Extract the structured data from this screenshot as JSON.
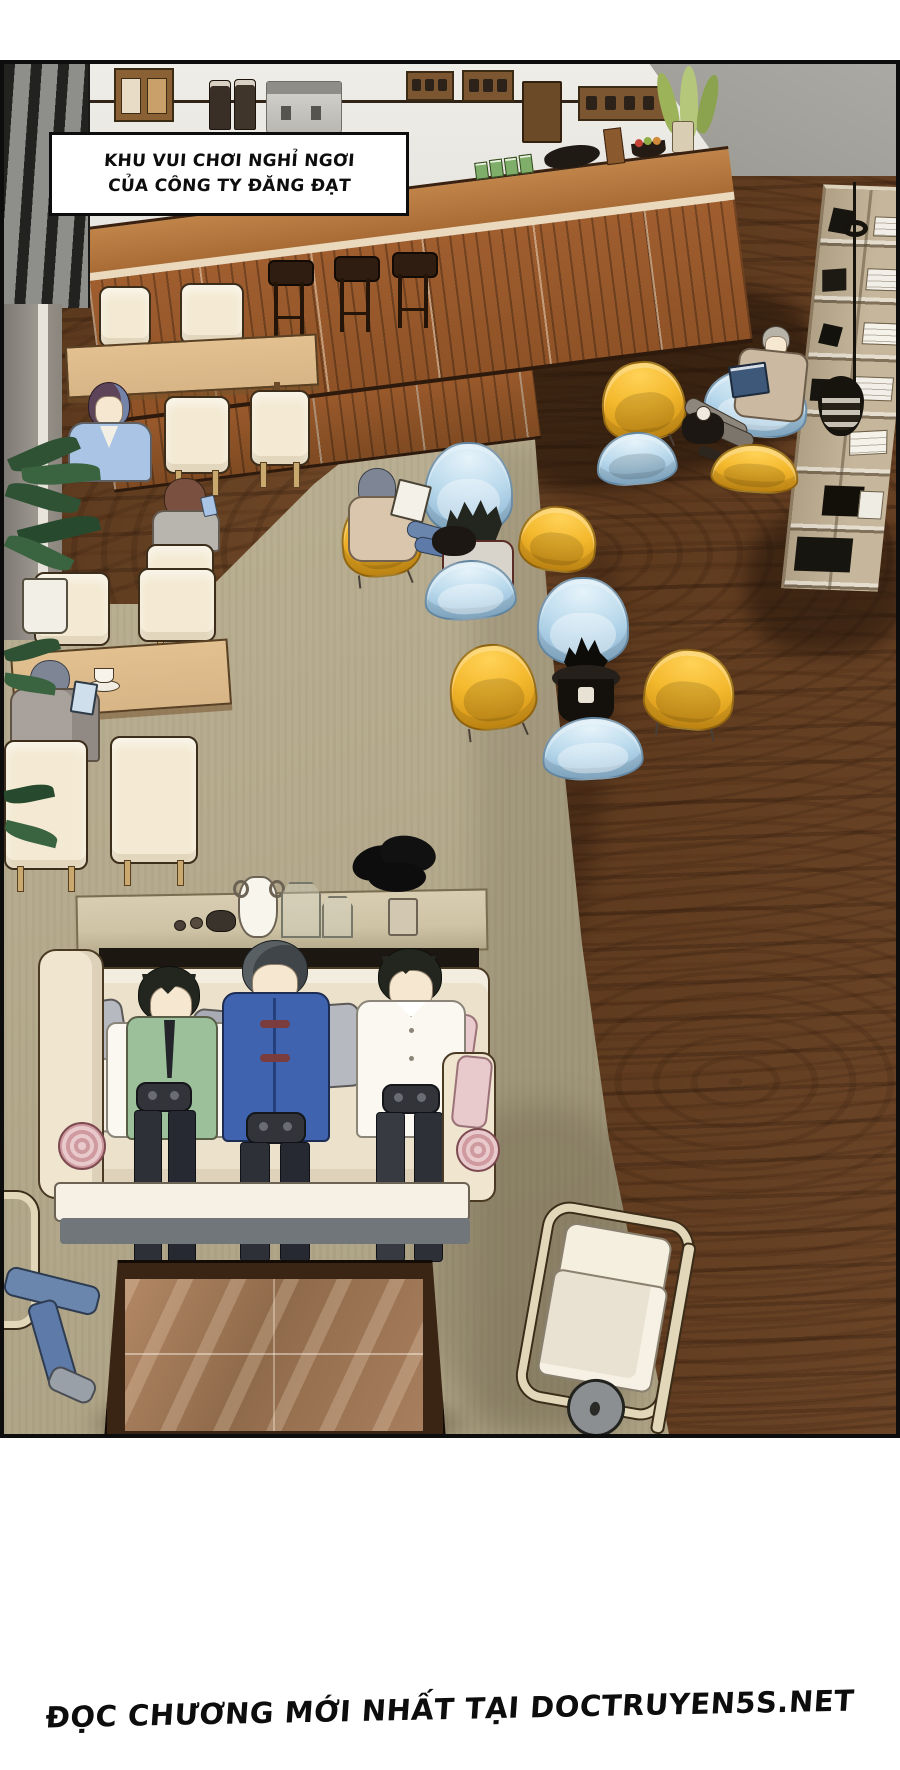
{
  "comic": {
    "caption": {
      "line1": "KHU VUI CHƠI NGHỈ NGƠI",
      "line2": "CỦA CÔNG TY ĐĂNG ĐẠT"
    },
    "footer": "ĐỌC CHƯƠNG MỚI NHẤT TẠI DOCTRUYEN5S.NET"
  },
  "colors": {
    "paper": "#ffffff",
    "ink": "#0d0d0d",
    "wall-light": "#e9e7e2",
    "wall-dark": "#97968f",
    "slat-dark": "#222220",
    "wood-floor": "#6b4527",
    "wood-floor-dark": "#46290f",
    "carpet": "#b7ac8f",
    "counter-wood": "#a05e2f",
    "counter-top": "#b97f4a",
    "counter-trim": "#ead9bd",
    "stool-dark": "#2e1d10",
    "table-tan": "#d7b586",
    "chair-cream": "#f4ead3",
    "chair-yellow": "#f4b92e",
    "chair-yellow-deep": "#d29214",
    "chair-blue": "#b9d9ec",
    "chair-blue-deep": "#8cb6d3",
    "side-table-black": "#1c1712",
    "shelf-tan": "#c6b69b",
    "sofa-cream": "#ece2cc",
    "sofa-base": "#f6f1e4",
    "console-tan": "#cfc3a6",
    "coffee-table-frame": "#3a2413",
    "coffee-table-top": "#a87f5e",
    "skin": "#f6e7d0",
    "green-vest": "#9cc09a",
    "tang-blue": "#3f63ae",
    "shirt-white": "#fbf8f1",
    "pants-dark": "#2e3038",
    "jeans-blue": "#6b86ad",
    "jacket-skyblue": "#a9c4e4",
    "suit-gray": "#a9a29c",
    "cardigan-tan": "#d9c6ad",
    "hair-dark": "#23261f",
    "hair-gray": "#b8b3a8",
    "hair-blue-gray": "#7e8696",
    "hair-red-violet": "#5d4458",
    "hair-brown": "#7a5140",
    "plant-green": "#2e5233",
    "pillow-gray": "#b6b9c0",
    "pillow-pink": "#e8c9cc",
    "book-blue": "#3d5878",
    "lamp-dark": "#17130d"
  }
}
